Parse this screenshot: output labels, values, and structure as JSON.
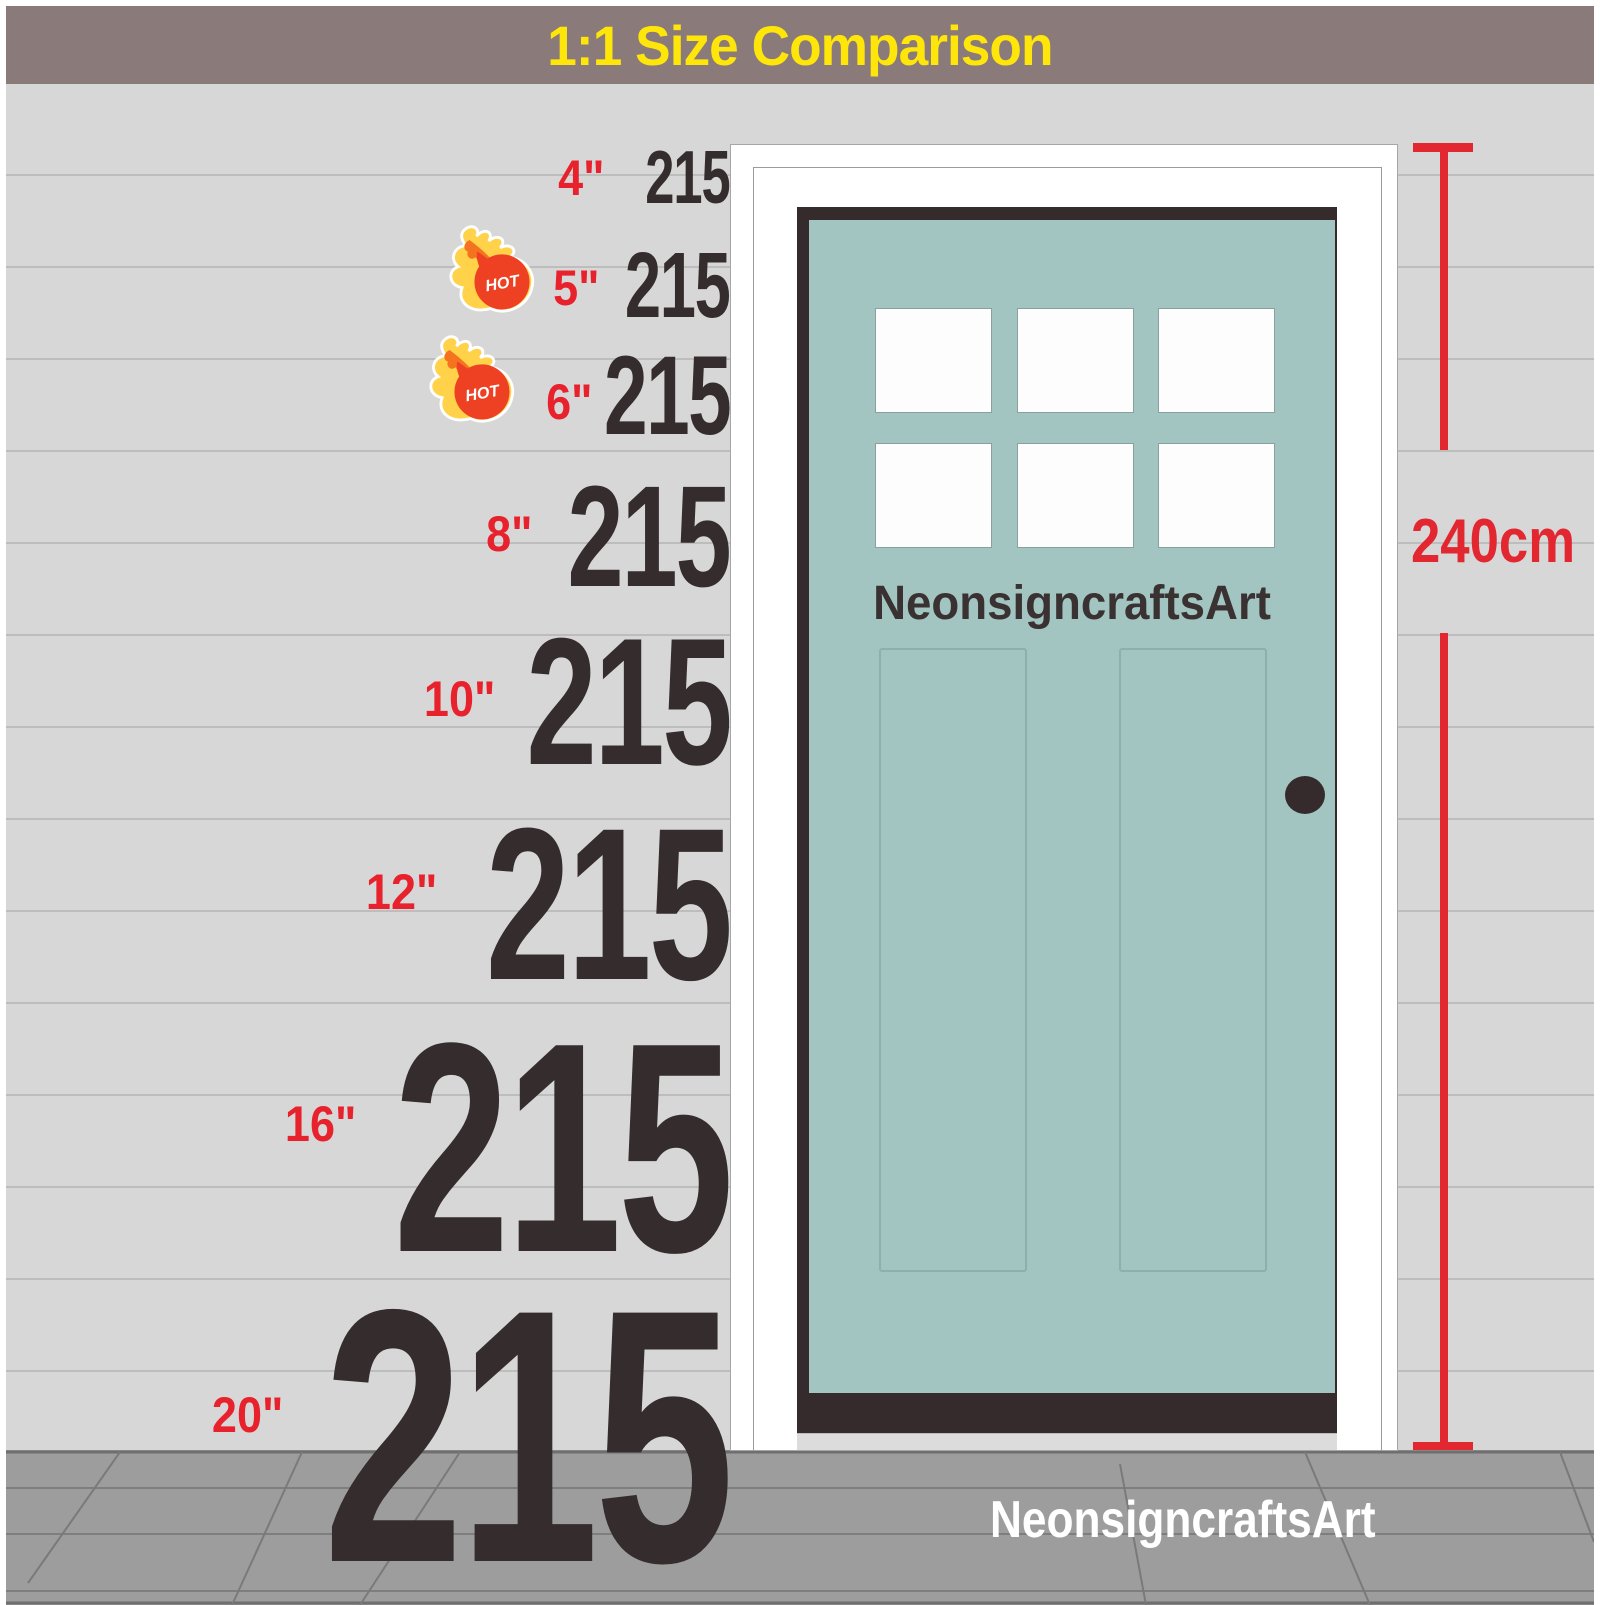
{
  "banner": {
    "title": "1:1 Size Comparison"
  },
  "door": {
    "label": "NeonsigncraftsArt"
  },
  "floor": {
    "watermark": "NeonsigncraftsArt"
  },
  "measurement": {
    "height_label": "240cm"
  },
  "hot_badge": {
    "text": "HOT"
  },
  "sizes": [
    {
      "label": "4\"",
      "value": "215",
      "hot": false
    },
    {
      "label": "5\"",
      "value": "215",
      "hot": true
    },
    {
      "label": "6\"",
      "value": "215",
      "hot": true
    },
    {
      "label": "8\"",
      "value": "215",
      "hot": false
    },
    {
      "label": "10\"",
      "value": "215",
      "hot": false
    },
    {
      "label": "12\"",
      "value": "215",
      "hot": false
    },
    {
      "label": "16\"",
      "value": "215",
      "hot": false
    },
    {
      "label": "20\"",
      "value": "215",
      "hot": false
    }
  ],
  "colors": {
    "banner_bg": "#8b7a7a",
    "banner_text": "#ffe60a",
    "wall": "#d7d7d7",
    "floor": "#9d9d9d",
    "door_teal": "#a3c5c2",
    "door_dark": "#362b2c",
    "accent_red": "#e32731",
    "number_dark": "#342c2d"
  }
}
